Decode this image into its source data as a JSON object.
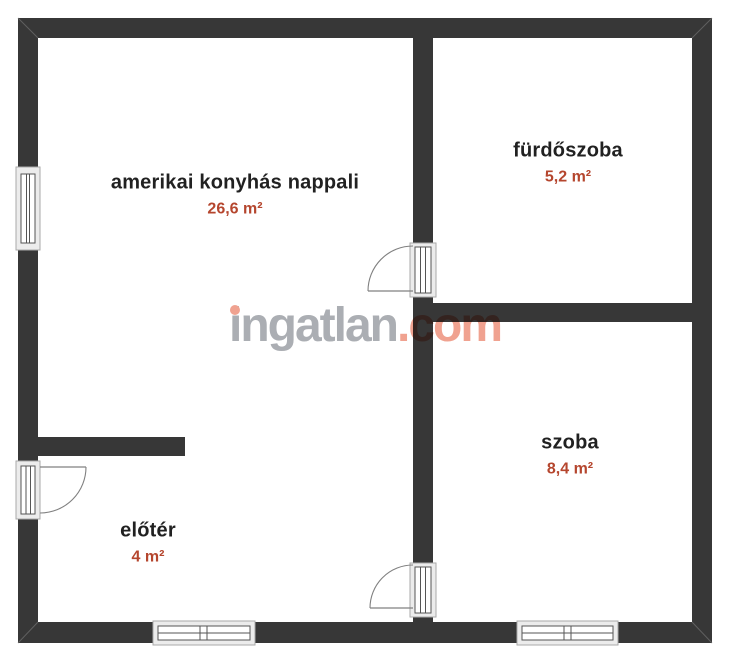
{
  "watermark": {
    "brand": "ingatlan",
    "tld": ".com"
  },
  "rooms": [
    {
      "id": "nappali",
      "name": "amerikai konyhás nappali",
      "area": "26,6 m²"
    },
    {
      "id": "furdoszoba",
      "name": "fürdőszoba",
      "area": "5,2 m²"
    },
    {
      "id": "szoba",
      "name": "szoba",
      "area": "8,4 m²"
    },
    {
      "id": "eloter",
      "name": "előtér",
      "area": "4 m²"
    }
  ],
  "colors": {
    "wall": "#373737",
    "room_text": "#212121",
    "area_text": "#b5462e",
    "watermark_gray": "#abaeb3",
    "watermark_accent": "#f0a290",
    "frame_line": "#555555",
    "frame_fill": "#ececec"
  }
}
